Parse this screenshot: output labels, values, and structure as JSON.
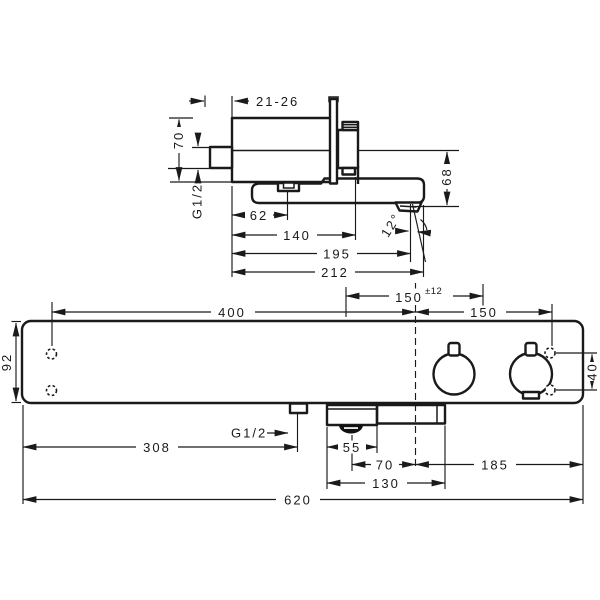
{
  "colors": {
    "line": "#1a1a1a",
    "background": "#ffffff"
  },
  "side_view": {
    "dim_depth_range": "21-26",
    "dim_height": "70",
    "thread_label": "G1/2",
    "dim_62": "62",
    "dim_140": "140",
    "dim_195": "195",
    "dim_212": "212",
    "dim_68": "68",
    "dim_spout_angle": "12°"
  },
  "front_view": {
    "dim_400": "400",
    "dim_150_tol_main": "150",
    "dim_150_tol_sup": "±12",
    "dim_150": "150",
    "dim_92": "92",
    "dim_40": "40",
    "thread_label": "G1/2",
    "dim_308": "308",
    "dim_55": "55",
    "dim_70": "70",
    "dim_130": "130",
    "dim_185": "185",
    "dim_620": "620"
  }
}
